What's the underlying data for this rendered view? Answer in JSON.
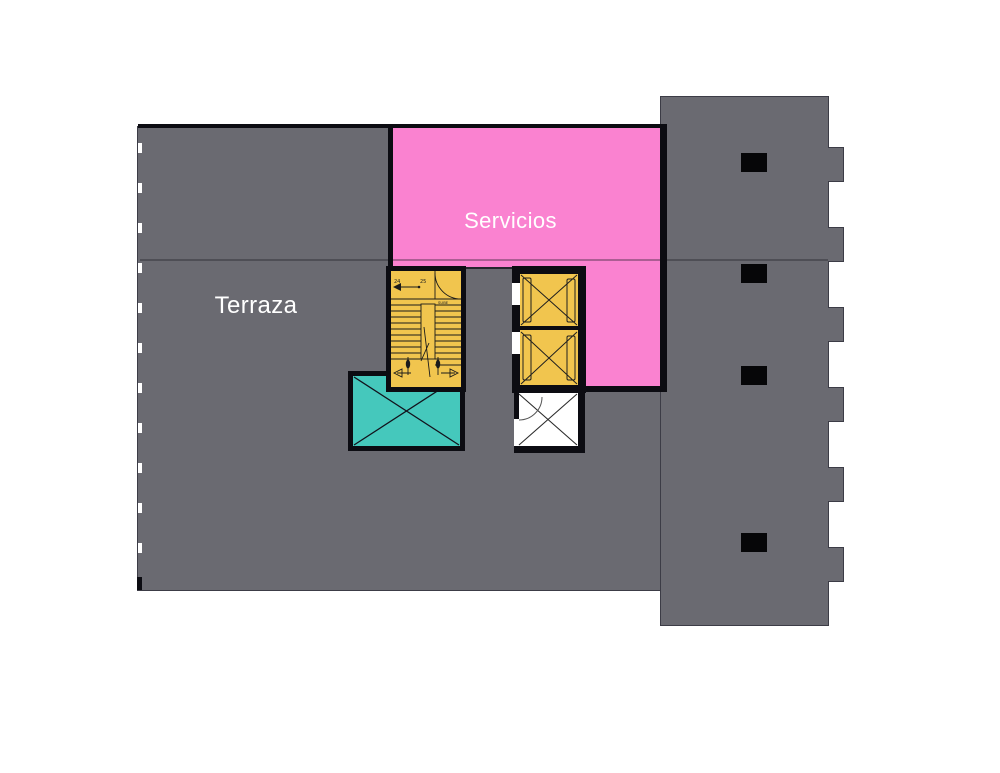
{
  "plan": {
    "title": "roof-terrace-floor-plan",
    "rooms": {
      "terraza": {
        "label": "Terraza",
        "color": "#6a6a71"
      },
      "servicios": {
        "label": "Servicios",
        "color": "#fa82d0"
      }
    },
    "stairwell": {
      "step_label_a": "24",
      "step_label_b": "25",
      "direction_label": "SUBE",
      "color": "#f1c54e"
    },
    "elevators": {
      "count": 2,
      "color": "#f1c54e"
    },
    "shafts": {
      "skylight_color": "#45c8bc",
      "open_shaft_color": "#ffffff"
    },
    "structure": {
      "column_count": 4,
      "facade_tooth_count": 6
    }
  },
  "colors": {
    "bg": "#ffffff",
    "gray": "#6a6a71",
    "pink": "#fa82d0",
    "yellow": "#f1c54e",
    "teal": "#45c8bc",
    "line": "#0c0c12",
    "outline": "#3c3c46"
  }
}
